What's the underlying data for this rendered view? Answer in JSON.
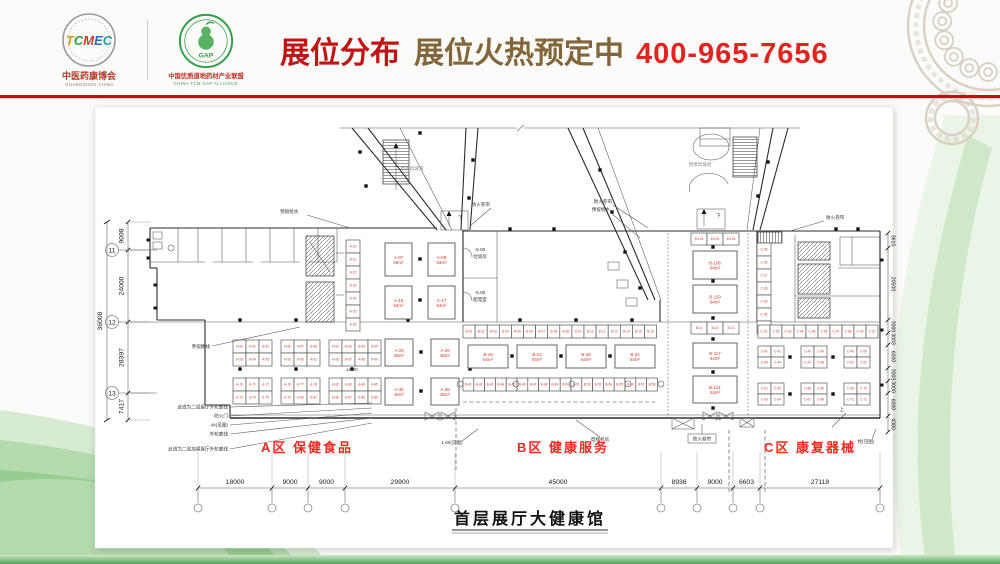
{
  "colors": {
    "accent_red": "#b51414",
    "title_red": "#c31414",
    "title_brown": "#82663a",
    "phone_red": "#e4231f",
    "booth_red": "#d53425",
    "zone_red": "#ed2b1f",
    "decor_tan": "#d9d0c3",
    "decor_green": "#9fce98",
    "bar_green": "#4ea25a"
  },
  "header": {
    "logo_left": {
      "acronym": "TCMEC",
      "name": "中医药康博会",
      "sub": "GUANGZHOU CHINA"
    },
    "logo_right": {
      "acronym": "GAP",
      "name": "中国优质道地药材产业联盟",
      "sub": "CHINA TCM GAP ALLIANCE"
    },
    "title": "展位分布",
    "subtitle": "展位火热预定中",
    "phone": "400-965-7656"
  },
  "plan": {
    "title": "首层展厅大健康馆",
    "zones": [
      {
        "id": "A",
        "label": "A区  保健食品"
      },
      {
        "id": "B",
        "label": "B区  健康服务"
      },
      {
        "id": "C",
        "label": "C区  康复器械"
      }
    ],
    "dims_bottom": [
      "18000",
      "9000",
      "9000",
      "29900",
      "45000",
      "8936",
      "9000",
      "6603",
      "27118"
    ],
    "dims_left": [
      "9098",
      "24000",
      "28397",
      "7417"
    ],
    "dim_left_total": "36000",
    "dims_right": [
      "3610",
      "20500",
      "3000",
      "3003",
      "6000",
      "3003",
      "3000",
      "6000",
      "4380"
    ],
    "grid_bubbles": [
      "11",
      "12",
      "13"
    ],
    "ann": {
      "yuliu": "预留给水",
      "fhjl": "防火卷帘",
      "podao": "原建筑坡道",
      "xia": "下",
      "shang": "上",
      "lvl": "-5.00",
      "lvl0": "±0.00",
      "laji": "垃圾房",
      "peidian": "配电室",
      "dianti": "电梯机房",
      "canguan": "参观路线",
      "jiantu1": "1.60(见图)",
      "jiantu2": "栓(见图)",
      "left_notes": [
        "此线为二层展厅外轮廓线",
        "防火门",
        "4#(见图)",
        "外轮廓线",
        "此线为二层加建展厅外轮廓线"
      ]
    },
    "booths": {
      "a_strip": [
        "A-20",
        "A-21",
        "A-22",
        "A-23",
        "A-24",
        "A-25",
        "A-26"
      ],
      "a_upper": [
        {
          "n": "A-07",
          "s": "63m²"
        },
        {
          "n": "A-09",
          "s": "63m²"
        },
        {
          "n": "A-15",
          "s": "54m²"
        },
        {
          "n": "A-17",
          "s": "54m²"
        }
      ],
      "a_cluster_row1": [
        "A-50",
        "A-51",
        "A-52",
        "A-53",
        "A-54",
        "A-55",
        "A-56",
        "A-57",
        "A-58",
        "A-59",
        "A-60",
        "A-61",
        "A-62",
        "A-63",
        "A-64",
        "A-65",
        "A-66",
        "A-67",
        "A-68",
        "A-69"
      ],
      "a_row1_large": [
        {
          "n": "A-28",
          "s": "36m²"
        },
        {
          "n": "A-29",
          "s": "36m²"
        }
      ],
      "a_cluster_row2": [
        "A-70",
        "A-71",
        "A-72",
        "A-73",
        "A-74",
        "A-75",
        "A-76",
        "A-77",
        "A-78",
        "A-79",
        "A-80",
        "A-81",
        "A-82",
        "A-83",
        "A-84",
        "A-85",
        "A-86",
        "A-87",
        "A-88",
        "A-89"
      ],
      "a_row2_large": [
        {
          "n": "A-35",
          "s": "36m²"
        },
        {
          "n": "A-36",
          "s": "36m²"
        }
      ],
      "b_strip_top": [
        "B-01",
        "B-02",
        "B-03",
        "B-04",
        "B-05",
        "B-06",
        "B-07",
        "B-08",
        "B-09",
        "B-10",
        "B-11",
        "B-12",
        "B-13",
        "B-14",
        "B-15",
        "B-16"
      ],
      "b_mid_large": [
        {
          "n": "B-18",
          "s": "54m²"
        },
        {
          "n": "B-22",
          "s": "54m²"
        },
        {
          "n": "B-28",
          "s": "54m²"
        },
        {
          "n": "B-34",
          "s": "54m²"
        }
      ],
      "b_strip2": [
        "B-41",
        "B-42",
        "B-43",
        "B-44",
        "B-45",
        "B-46",
        "B-47",
        "B-48",
        "B-49",
        "B-50",
        "B-51",
        "B-52",
        "B-53",
        "B-54",
        "B-55",
        "B-56",
        "B-57",
        "B-58"
      ],
      "bc_top_strip": [
        "B-101",
        "B-102",
        "B-103"
      ],
      "bc_large": [
        {
          "n": "B-106",
          "s": "84m²"
        },
        {
          "n": "B-110",
          "s": "84m²"
        }
      ],
      "bc_bot_strip": [
        "B-11",
        "B-12",
        "B-13"
      ],
      "bc_bot_large": [
        {
          "n": "B-117",
          "s": "54m²"
        },
        {
          "n": "B-121",
          "s": "54m²"
        }
      ],
      "c_left_strip": [
        "C-25",
        "C-26",
        "C-27",
        "C-28",
        "C-29",
        "C-30",
        "C-31"
      ],
      "c_strip_top": [
        "C-01",
        "C-02",
        "C-03",
        "C-04",
        "C-05",
        "C-06",
        "C-07",
        "C-08",
        "C-09",
        "C-10"
      ],
      "c_cluster_row1": [
        "C-41",
        "C-42",
        "C-43",
        "C-44",
        "C-45",
        "C-46",
        "C-47",
        "C-48",
        "C-49",
        "C-50",
        "C-51",
        "C-52"
      ],
      "c_cluster_row2": [
        "C-61",
        "C-62",
        "C-63",
        "C-64",
        "C-65",
        "C-66",
        "C-67",
        "C-68",
        "C-69",
        "C-70",
        "C-71",
        "C-72"
      ]
    }
  }
}
